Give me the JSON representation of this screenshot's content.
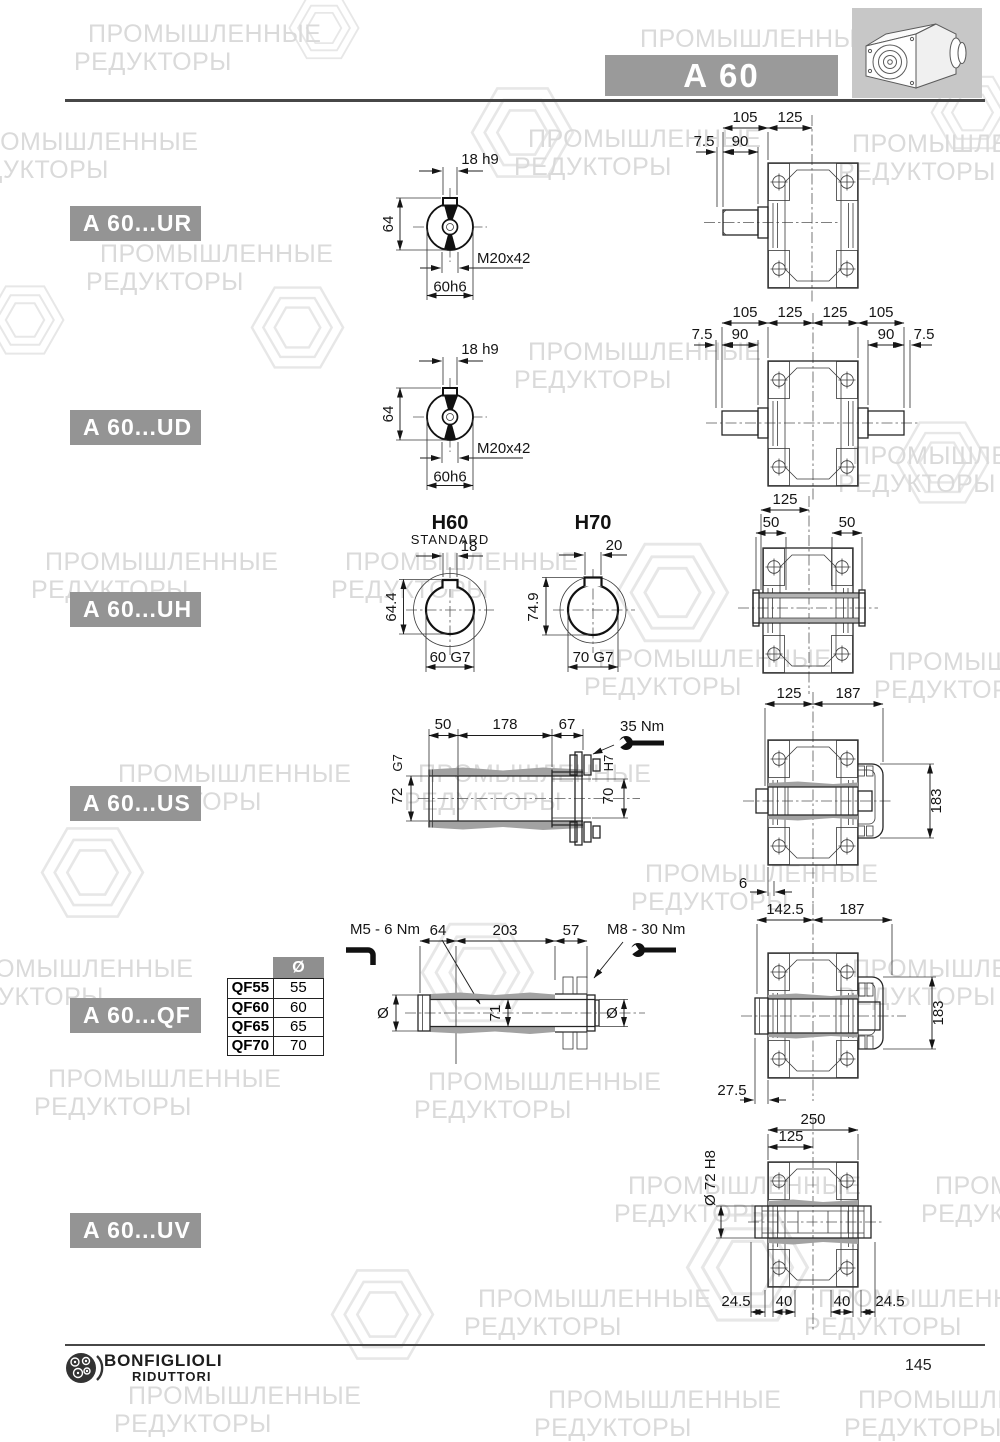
{
  "watermark": {
    "line1": "ПРОМЫШЛЕННЫЕ",
    "line2": "РЕДУКТОРЫ"
  },
  "header": {
    "model": "A 60"
  },
  "sections": {
    "ur": {
      "label": "A 60...UR",
      "shaft_end": {
        "keyway": "18 h9",
        "height": "64",
        "thread": "M20x42",
        "diameter": "60h6"
      },
      "front": {
        "top1": "105",
        "top2": "125",
        "sub1": "7.5",
        "sub2": "90"
      }
    },
    "ud": {
      "label": "A 60...UD",
      "shaft_end": {
        "keyway": "18 h9",
        "height": "64",
        "thread": "M20x42",
        "diameter": "60h6"
      },
      "front": {
        "top1": "105",
        "top2": "125",
        "top3": "125",
        "top4": "105",
        "sub1": "7.5",
        "sub2": "90",
        "sub3": "90",
        "sub4": "7.5"
      }
    },
    "uh": {
      "label": "A 60...UH",
      "h60": {
        "title": "H60",
        "subtitle": "STANDARD",
        "keyway": "18",
        "height": "64.4",
        "bore": "60 G7"
      },
      "h70": {
        "title": "H70",
        "keyway": "20",
        "height": "74.9",
        "bore": "70 G7"
      },
      "front": {
        "top": "125",
        "left": "50",
        "right": "50"
      }
    },
    "us": {
      "label": "A 60...US",
      "side": {
        "len1": "50",
        "len2": "178",
        "len3": "67",
        "torque": "35 Nm",
        "fit_left": "G7",
        "dia_left": "72",
        "fit_right": "H7",
        "dia_right": "70"
      },
      "front": {
        "top1": "125",
        "top2": "187",
        "height": "183",
        "offset": "6"
      }
    },
    "qf": {
      "label": "A 60...QF",
      "table": {
        "col_header": "Ø",
        "rows": [
          {
            "type": "QF55",
            "dia": "55"
          },
          {
            "type": "QF60",
            "dia": "60"
          },
          {
            "type": "QF65",
            "dia": "65"
          },
          {
            "type": "QF70",
            "dia": "70"
          }
        ]
      },
      "side": {
        "torque_left": "M5 - 6 Nm",
        "len1": "64",
        "len2": "203",
        "len3": "57",
        "torque_right": "M8 - 30 Nm",
        "bore": "71",
        "dia_left": "Ø",
        "dia_right": "Ø"
      },
      "front": {
        "top1": "142.5",
        "top2": "187",
        "height": "183",
        "offset": "27.5"
      }
    },
    "uv": {
      "label": "A 60...UV",
      "front": {
        "width": "250",
        "half": "125",
        "bore": "Ø 72 H8",
        "b1": "24.5",
        "b2": "40",
        "b3": "40",
        "b4": "24.5"
      }
    }
  },
  "footer": {
    "brand1": "BONFIGLIOLI",
    "brand2": "RIDUTTORI",
    "page": "145"
  }
}
